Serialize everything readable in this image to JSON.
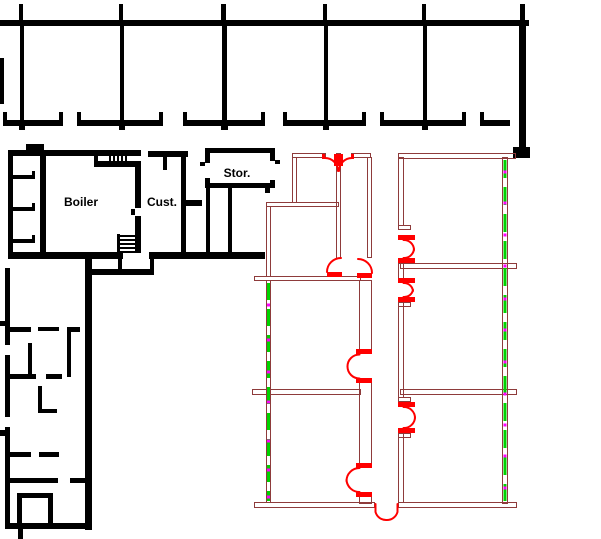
{
  "drawing": {
    "type": "floor-plan",
    "labels": {
      "boiler": "Boiler",
      "custodian": "Cust.",
      "storage": "Stor."
    },
    "colors": {
      "background": "#ffffff",
      "existing_walls": "#000000",
      "new_walls": "#8e3b3b",
      "doors": "#ff0000",
      "overlay_dash": "#00d300",
      "overlay_dot": "#ff00ff",
      "label_text": "#000000"
    }
  }
}
